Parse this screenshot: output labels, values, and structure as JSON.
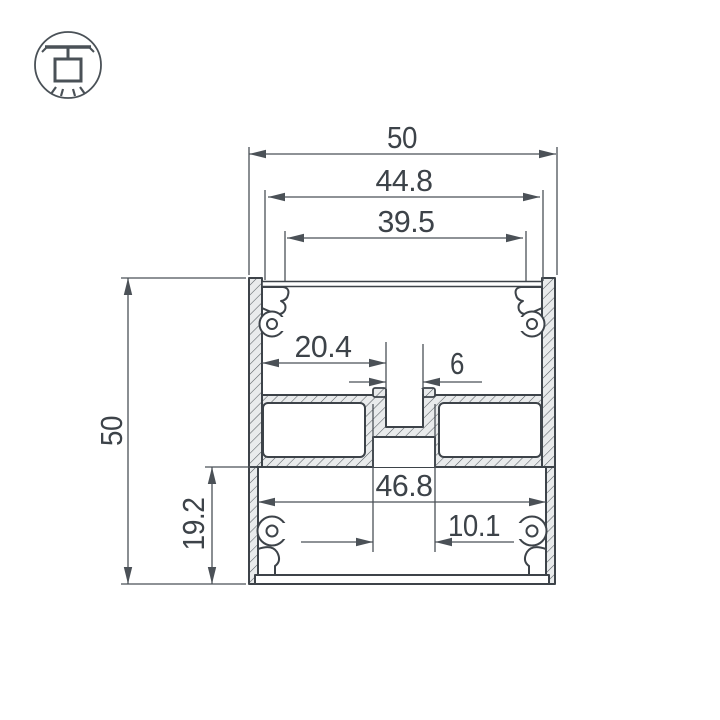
{
  "logo": {
    "icon": "pendant-lamp-icon"
  },
  "drawing": {
    "dimensions": {
      "overall_width": "50",
      "cover_ledge_width": "44.8",
      "top_opening_width": "39.5",
      "side_pocket_width": "20.4",
      "center_slot_width": "6",
      "overall_height": "50",
      "lower_section_height": "19.2",
      "bottom_cavity_width": "46.8",
      "bottom_slot_width": "10.1"
    },
    "colors": {
      "outline": "#3d4349",
      "dimension_line": "#4b5157",
      "hatch_fill": "#e9ebec",
      "background": "#ffffff"
    }
  }
}
